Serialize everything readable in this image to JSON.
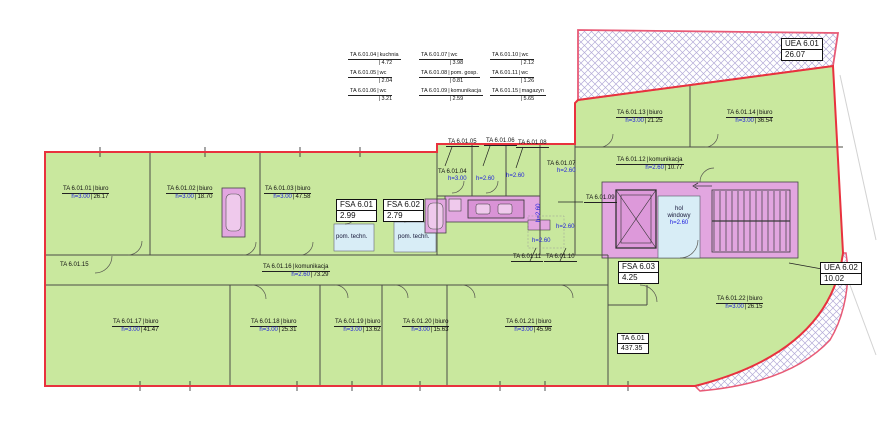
{
  "colors": {
    "floor_green": "#c9e89e",
    "outline_red": "#e8323e",
    "hatch_border_pink": "#e85a76",
    "hatch_lavender": "#b4abd8",
    "sanitary_pink": "#e2a6e0",
    "fixture_pink": "#efc9ec",
    "fixture_dark_pink": "#d993d6",
    "tech_blue": "#d8edf6",
    "label_blue": "#1c1cdd"
  },
  "legend": {
    "entries": [
      {
        "id": "TA 6.01.04",
        "name": "kuchnia",
        "area": "4.72"
      },
      {
        "id": "TA 6.01.05",
        "name": "wc",
        "area": "2.04"
      },
      {
        "id": "TA 6.01.06",
        "name": "wc",
        "area": "3.21"
      },
      {
        "id": "TA 6.01.07",
        "name": "wc",
        "area": "3.98"
      },
      {
        "id": "TA 6.01.08",
        "name": "pom. gosp.",
        "area": "0.81"
      },
      {
        "id": "TA 6.01.09",
        "name": "komunikacja",
        "area": "2.59"
      },
      {
        "id": "TA 6.01.10",
        "name": "wc",
        "area": "2.12"
      },
      {
        "id": "TA 6.01.11",
        "name": "wc",
        "area": "1.26"
      },
      {
        "id": "TA 6.01.15",
        "name": "magazyn",
        "area": "5.65"
      }
    ]
  },
  "rooms": [
    {
      "id": "TA 6.01.01",
      "name": "biuro",
      "h": "h=3.00",
      "area": "26.17"
    },
    {
      "id": "TA 6.01.02",
      "name": "biuro",
      "h": "h=3.00",
      "area": "18.70"
    },
    {
      "id": "TA 6.01.03",
      "name": "biuro",
      "h": "h=3.00",
      "area": "47.58"
    },
    {
      "id": "TA 6.01.12",
      "name": "komunikacja",
      "h": "h=2.60",
      "area": "10.77"
    },
    {
      "id": "TA 6.01.13",
      "name": "biuro",
      "h": "h=3.00",
      "area": "21.25"
    },
    {
      "id": "TA 6.01.14",
      "name": "biuro",
      "h": "h=3.00",
      "area": "36.54"
    },
    {
      "id": "TA 6.01.16",
      "name": "komunikacja",
      "h": "h=2.60",
      "area": "73.29"
    },
    {
      "id": "TA 6.01.17",
      "name": "biuro",
      "h": "h=3.00",
      "area": "41.47"
    },
    {
      "id": "TA 6.01.18",
      "name": "biuro",
      "h": "h=3.00",
      "area": "25.31"
    },
    {
      "id": "TA 6.01.19",
      "name": "biuro",
      "h": "h=3.00",
      "area": "13.62"
    },
    {
      "id": "TA 6.01.20",
      "name": "biuro",
      "h": "h=3.00",
      "area": "15.63"
    },
    {
      "id": "TA 6.01.21",
      "name": "biuro",
      "h": "h=3.00",
      "area": "45.96"
    },
    {
      "id": "TA 6.01.22",
      "name": "biuro",
      "h": "h=3.00",
      "area": "26.15"
    }
  ],
  "small_labels": [
    {
      "id": "TA 6.01.04",
      "h": "h=3.00"
    },
    {
      "id": "TA 6.01.07",
      "h": "h=2.60"
    }
  ],
  "leaders": [
    "TA 6.01.05",
    "TA 6.01.06",
    "TA 6.01.08",
    "TA 6.01.09",
    "TA 6.01.11",
    "TA 6.01.10",
    "TA 6.01.15"
  ],
  "heights": {
    "h260": "h=2.60"
  },
  "hol": {
    "l1": "hol",
    "l2": "windowy",
    "h": "h=2.60"
  },
  "pom_techn": "pom. techn.",
  "boxes": {
    "uea1": {
      "id": "UEA 6.01",
      "area": "26.07"
    },
    "uea2": {
      "id": "UEA 6.02",
      "area": "10.02"
    },
    "fsa1": {
      "id": "FSA 6.01",
      "area": "2.99"
    },
    "fsa2": {
      "id": "FSA 6.02",
      "area": "2.79"
    },
    "fsa3": {
      "id": "FSA 6.03",
      "area": "4.25"
    },
    "total": {
      "id": "TA 6.01",
      "area": "437.35"
    }
  }
}
